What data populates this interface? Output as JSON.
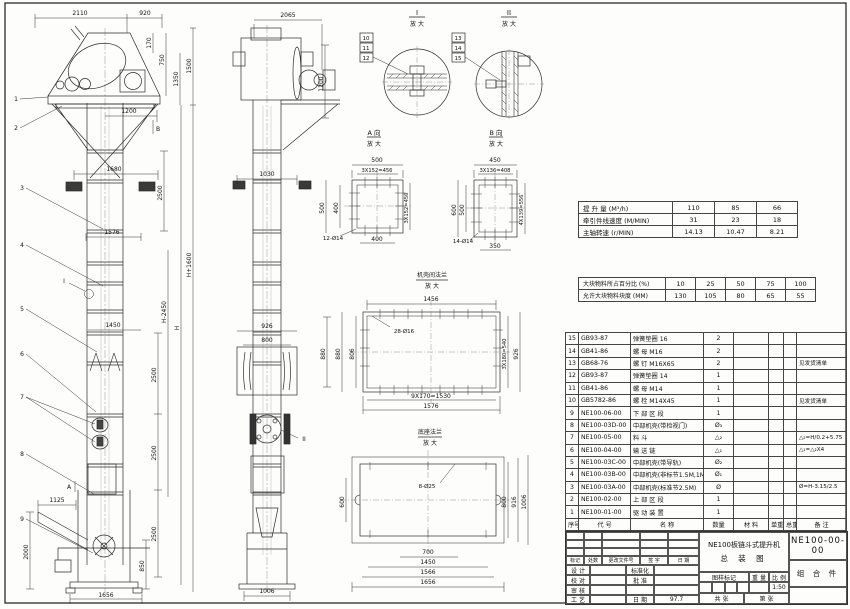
{
  "front": {
    "callouts": [
      "1",
      "2",
      "3",
      "4",
      "5",
      "6",
      "7",
      "8",
      "9"
    ],
    "dims": {
      "top1": "2110",
      "top2": "920",
      "r170": "170",
      "r750": "750",
      "r1350": "1350",
      "r1500": "1500",
      "d1200": "1200",
      "markB": "B",
      "w1680": "1680",
      "c2500a": "2500",
      "w1576": "1576",
      "markI": "I",
      "w1450": "1450",
      "c2500b": "2500",
      "c2500c": "2500",
      "c2500d": "2500",
      "d1125": "1125",
      "v2000": "2000",
      "v850": "850",
      "w1656": "1656",
      "hm": "H-2450",
      "h": "H",
      "hp": "H+1600",
      "markA": "A"
    }
  },
  "side": {
    "dims": {
      "top": "2065",
      "v1200": "1200",
      "w1030": "1030",
      "w926": "926",
      "w800": "800",
      "v880": "880",
      "w1006": "1006",
      "markII": "II"
    }
  },
  "det": {
    "i": {
      "title": "I",
      "sub": "放 大",
      "tags": [
        "10",
        "11",
        "12"
      ]
    },
    "ii": {
      "title": "II",
      "sub": "放 大",
      "tags": [
        "13",
        "14",
        "15"
      ]
    },
    "a": {
      "title": "A 向",
      "sub": "放 大",
      "d": [
        "500",
        "3X152=456",
        "500",
        "400",
        "3X152=456",
        "400",
        "12-Ø14"
      ]
    },
    "b": {
      "title": "B 向",
      "sub": "放 大",
      "d": [
        "450",
        "3X136=408",
        "600",
        "500",
        "4X139=556",
        "350",
        "14-Ø14"
      ]
    },
    "fl": {
      "title": "机壳间法兰",
      "sub": "放 大",
      "d": [
        "1456",
        "880",
        "806",
        "3X180=540",
        "926",
        "9X170=1530",
        "1576",
        "28-Ø16"
      ]
    },
    "base": {
      "title": "底座法兰",
      "sub": "放 大",
      "d": [
        "600",
        "800",
        "916",
        "1006",
        "700",
        "1450",
        "1566",
        "1656",
        "8-Ø25"
      ]
    }
  },
  "notes": {
    "lines1": [
      "  说明:",
      "1. 驱动装置分左装和右装两种.",
      "   左装——面对进料口,驱动装置在左侧.",
      "   右装——面对进料口,驱动装置在右侧.",
      "2. 机型表示法:",
      "   NE100--提升机高度H(M)--提升量(M³/h)--左(右)装.",
      "   驱动装置型号: JZQ(减速机型号)-速比-机型号",
      "        Y(电动机型号)-极数-功率",
      "",
      "  技术性能:",
      "1. 料斗容积: 0.033 M³.",
      "2. 斗  距: 0.4 M.",
      "3. 斗  宽: 0.4 M.",
      "4. 提升量,牵引件线速度和主轴转速:"
    ],
    "lines2": [
      "5. 填充系数按 0.7计算.",
      "6. 牵引件安全系数 >1倍.",
      "7. 物料块度:"
    ]
  },
  "cap": {
    "rows": [
      [
        "提 升 量  (M³/h)",
        "110",
        "85",
        "66"
      ],
      [
        "牵引件线速度 (M/MIN)",
        "31",
        "23",
        "18"
      ],
      [
        "主轴转速  (r/MIN)",
        "14.13",
        "10.47",
        "8.21"
      ]
    ]
  },
  "lump": {
    "rows": [
      [
        "大块物料所占百分比 (%)",
        "10",
        "25",
        "50",
        "75",
        "100"
      ],
      [
        "允许大块物料块度 (MM)",
        "130",
        "105",
        "80",
        "65",
        "55"
      ]
    ]
  },
  "bom": {
    "header": [
      "序号",
      "代  号",
      "名  称",
      "数量",
      "材  料",
      "单重",
      "总重",
      "备  注"
    ],
    "rows": [
      [
        "15",
        "GB93-87",
        "弹簧垫圈  16",
        "2",
        "",
        "",
        "",
        ""
      ],
      [
        "14",
        "GB41-86",
        "螺 母  M16",
        "2",
        "",
        "",
        "",
        ""
      ],
      [
        "13",
        "GB68-76",
        "螺 钉  M16X65",
        "2",
        "",
        "",
        "",
        "见发货清单"
      ],
      [
        "12",
        "GB93-87",
        "弹簧垫圈  14",
        "1",
        "",
        "",
        "",
        ""
      ],
      [
        "11",
        "GB41-86",
        "螺 母  M14",
        "1",
        "",
        "",
        "",
        ""
      ],
      [
        "10",
        "GB5782-86",
        "螺 栓  M14X45",
        "1",
        "",
        "",
        "",
        "见发货清单"
      ],
      [
        "9",
        "NE100-06-00",
        "下 部 区 段",
        "1",
        "",
        "",
        "",
        ""
      ],
      [
        "8",
        "NE100-03D-00",
        "中部机壳(带检视门)",
        "Ø₃",
        "",
        "",
        "",
        ""
      ],
      [
        "7",
        "NE100-05-00",
        "料  斗",
        "△₂",
        "",
        "",
        "",
        "△₂=H/0.2+5.75"
      ],
      [
        "6",
        "NE100-04-00",
        "输 送 链",
        "△₁",
        "",
        "",
        "",
        "△₁=△₂X4"
      ],
      [
        "5",
        "NE100-03C-00",
        "中部机壳(带导轨)",
        "Ø₂",
        "",
        "",
        "",
        ""
      ],
      [
        "4",
        "NE100-03B-00",
        "中部机壳(非标节1.5M,1M)",
        "Ø₁",
        "",
        "",
        "",
        ""
      ],
      [
        "3",
        "NE100-03A-00",
        "中部机壳(标准节2.5M)",
        "Ø",
        "",
        "",
        "",
        "Ø=H-3.15/2.5"
      ],
      [
        "2",
        "NE100-02-00",
        "上 部 区 段",
        "1",
        "",
        "",
        "",
        ""
      ],
      [
        "1",
        "NE100-01-00",
        "驱 动 装 置",
        "1",
        "",
        "",
        "",
        ""
      ]
    ]
  },
  "tb": {
    "rev": [
      "标记",
      "处数",
      "更改文件号",
      "签 字",
      "日 期"
    ],
    "r1l": "设 计",
    "r1m": "标准化",
    "r2l": "校 对",
    "r2m": "批 准",
    "r3l": "审 核",
    "r4l": "工 艺",
    "r4m": "日 期",
    "date": "97.7",
    "mark": "图样标记",
    "weight": "重 量",
    "scale_l": "比 例",
    "scale": "1:50",
    "sheets": "共  张",
    "sheet_no": "第  张",
    "title1": "NE100板链斗式提升机",
    "title2": "总  装  图",
    "dno": "NE100-00-00",
    "part": "组 合 件"
  }
}
